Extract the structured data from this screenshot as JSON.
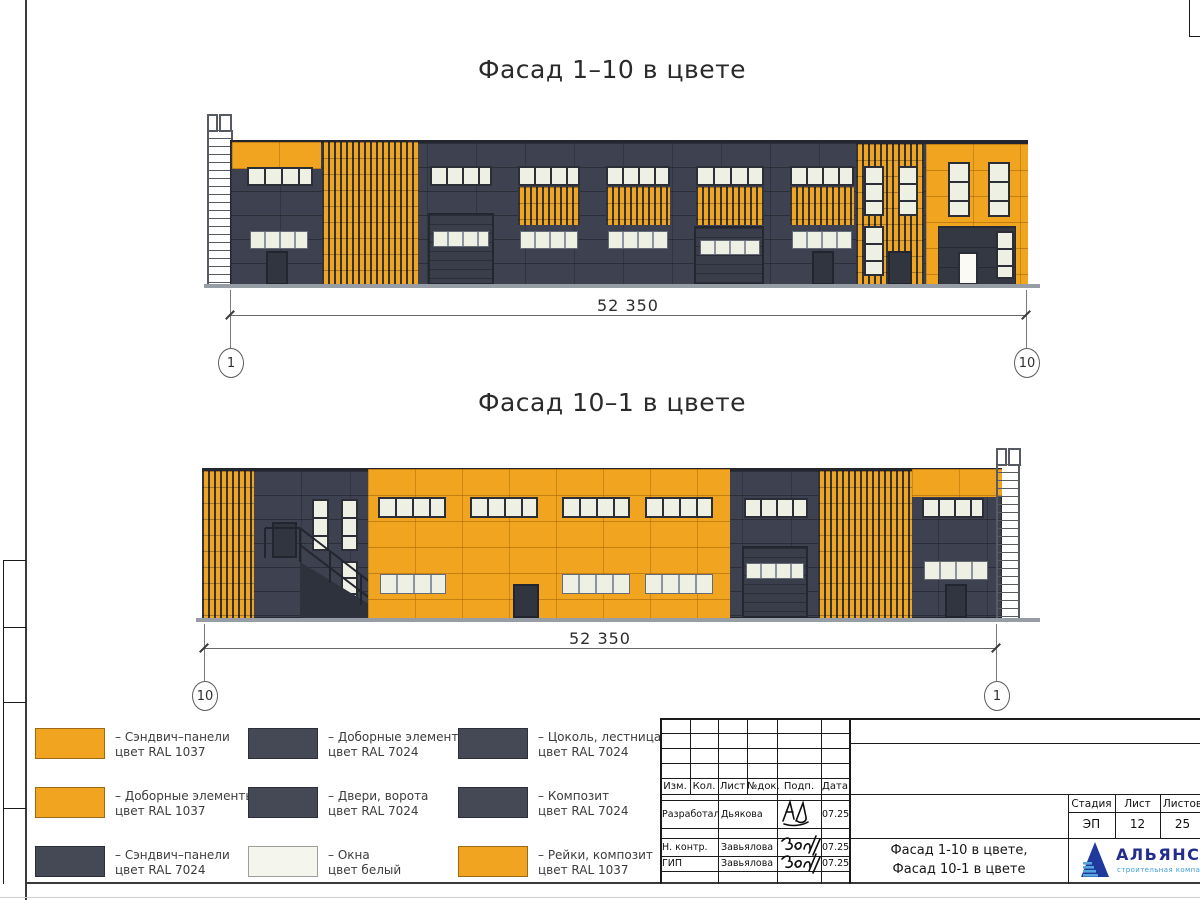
{
  "colors": {
    "orange": "#F0A41F",
    "dark": "#3E4250",
    "window": "#EEF0E4",
    "winframe": "#2B2E37",
    "ground": "#969DA5",
    "logo_blue": "#222D8C",
    "logo_light": "#3E9FD8"
  },
  "drawings": [
    {
      "title": "Фасад 1–10 в цвете",
      "dimension": "52 350",
      "axis_left": "1",
      "axis_right": "10"
    },
    {
      "title": "Фасад 10–1 в цвете",
      "dimension": "52 350",
      "axis_left": "10",
      "axis_right": "1"
    }
  ],
  "legend": {
    "items": [
      {
        "line1": "– Сэндвич–панели",
        "line2": "цвет RAL 1037",
        "color": "#F0A41F"
      },
      {
        "line1": "– Доборные элементы",
        "line2": "цвет RAL 1037",
        "color": "#F0A41F"
      },
      {
        "line1": "– Сэндвич–панели",
        "line2": "цвет RAL 7024",
        "color": "#454956"
      },
      {
        "line1": "– Доборные элементы",
        "line2": "цвет RAL 7024",
        "color": "#454956"
      },
      {
        "line1": "– Двери, ворота",
        "line2": "цвет RAL 7024",
        "color": "#454956"
      },
      {
        "line1": "– Окна",
        "line2": "цвет белый",
        "color": "#F4F5EC"
      },
      {
        "line1": "– Цоколь, лестница",
        "line2": "цвет RAL 7024",
        "color": "#454956"
      },
      {
        "line1": "– Композит",
        "line2": "цвет RAL 7024",
        "color": "#454956"
      },
      {
        "line1": "– Рейки, композит",
        "line2": "цвет RAL 1037",
        "color": "#F0A41F"
      }
    ]
  },
  "titleblock": {
    "header_cols": [
      "Изм.",
      "Кол.",
      "Лист",
      "№док.",
      "Подп.",
      "Дата"
    ],
    "rows": [
      {
        "role": "Разработал",
        "name": "Дьякова",
        "date": "07.25"
      },
      {
        "role": "Н. контр.",
        "name": "Завьялова",
        "date": "07.25"
      },
      {
        "role": "ГИП",
        "name": "Завьялова",
        "date": "07.25"
      }
    ],
    "doc_name_line1": "Фасад 1-10 в цвете,",
    "doc_name_line2": "Фасад 10-1 в цвете",
    "stage_label": "Стадия",
    "sheet_label": "Лист",
    "sheets_label": "Листов",
    "stage_value": "ЭП",
    "sheet_value": "12",
    "sheets_value": "25",
    "logo_text": "АЛЬЯНС",
    "logo_tagline": "строительная компания"
  }
}
